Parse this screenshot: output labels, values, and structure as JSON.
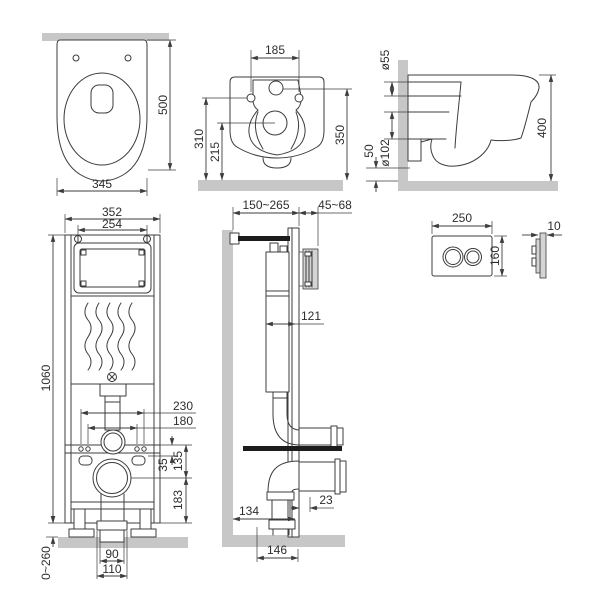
{
  "drawing": {
    "background": "#ffffff",
    "line_color": "#3c3c3c",
    "wall_fill": "#c7c7c7",
    "views": {
      "toilet_top": {
        "dim_width": "345",
        "dim_depth": "500"
      },
      "toilet_back": {
        "dim_hole_spacing": "185",
        "dim_rim_height": "310",
        "dim_outlet_height": "215",
        "dim_inlet_height": "350"
      },
      "toilet_side": {
        "dim_inlet_diameter": "ø55",
        "dim_outlet_diameter": "ø102",
        "dim_outlet_floor_offset": "50",
        "dim_depth": "400"
      },
      "frame_front": {
        "dim_width": "352",
        "dim_top_bolt_spacing": "254",
        "dim_height": "1060",
        "dim_fixing_outer": "230",
        "dim_fixing_inner": "180",
        "dim_rail_offset": "35",
        "dim_outlet_drop": "135",
        "dim_outlet_to_base": "183",
        "dim_outlet_pipe": "90",
        "dim_outlet_collar": "110",
        "dim_leg_adjustment": "0~260"
      },
      "frame_side": {
        "dim_install_depth": "150~265",
        "dim_plate_recess": "45~68",
        "dim_cistern_depth": "121",
        "dim_front_offset": "23",
        "dim_wall_to_outlet": "134",
        "dim_outlet_run": "146"
      },
      "flush_plate": {
        "dim_width": "250",
        "dim_height": "160",
        "dim_thickness": "10"
      }
    }
  }
}
